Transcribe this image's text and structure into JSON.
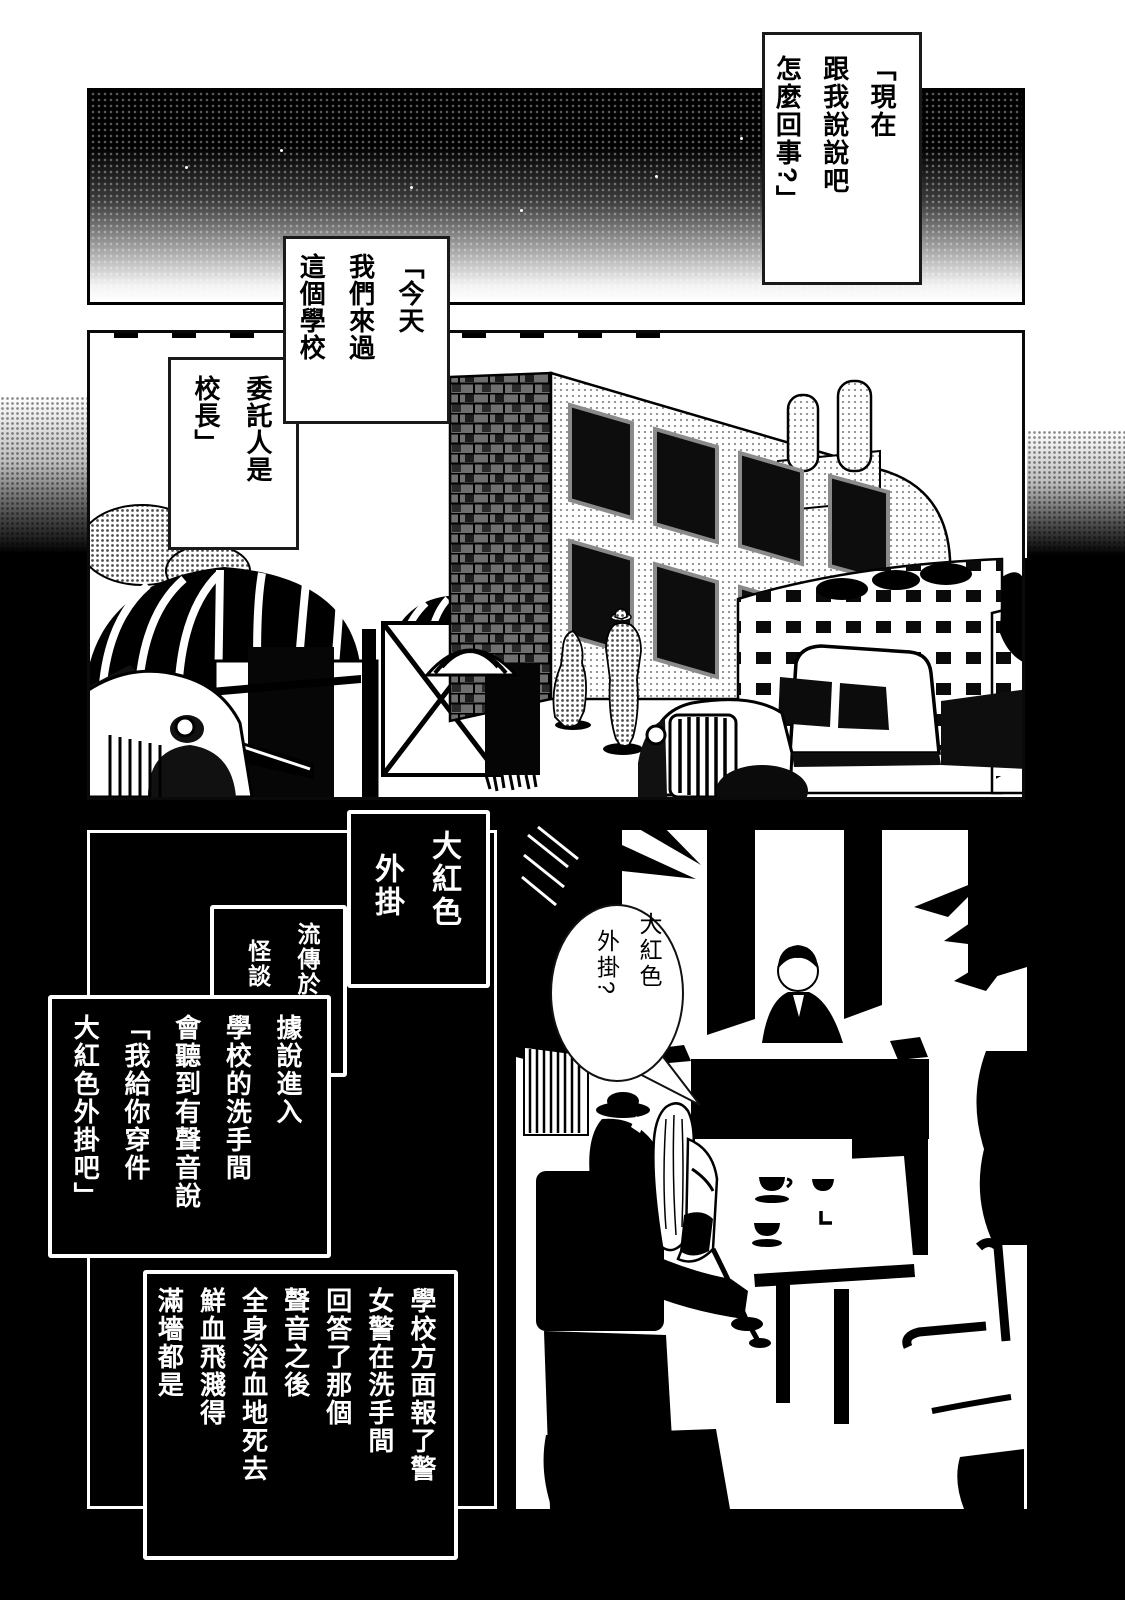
{
  "bubbles": {
    "opening": {
      "lines": [
        "「現在",
        "跟我說說吧",
        "怎麼回事?」"
      ]
    },
    "today": {
      "lines": [
        "「今天",
        "我們來過",
        "這個學校"
      ]
    },
    "client": {
      "lines": [
        "委託人是",
        "校長」"
      ]
    },
    "principal_reply": {
      "lines": [
        "大紅色",
        "外掛?"
      ]
    }
  },
  "title_box": {
    "lines": [
      "大紅色",
      "外掛"
    ]
  },
  "narration": {
    "legend_intro": {
      "lines": [
        "流傳於日本的",
        "怪談"
      ]
    },
    "legend_detail": {
      "lines": [
        "據說進入",
        "學校的洗手間",
        "會聽到有聲音說",
        "「我給你穿件",
        "大紅色外掛吧」"
      ]
    },
    "incident": {
      "lines": [
        "學校方面報了警",
        "女警在洗手間",
        "回答了那個",
        "聲音之後",
        "全身浴血地死去",
        "鮮血飛濺得",
        "滿墻都是"
      ]
    }
  },
  "decor": {
    "wall_mark": "L"
  },
  "colors": {
    "ink": "#000000",
    "paper": "#ffffff"
  }
}
